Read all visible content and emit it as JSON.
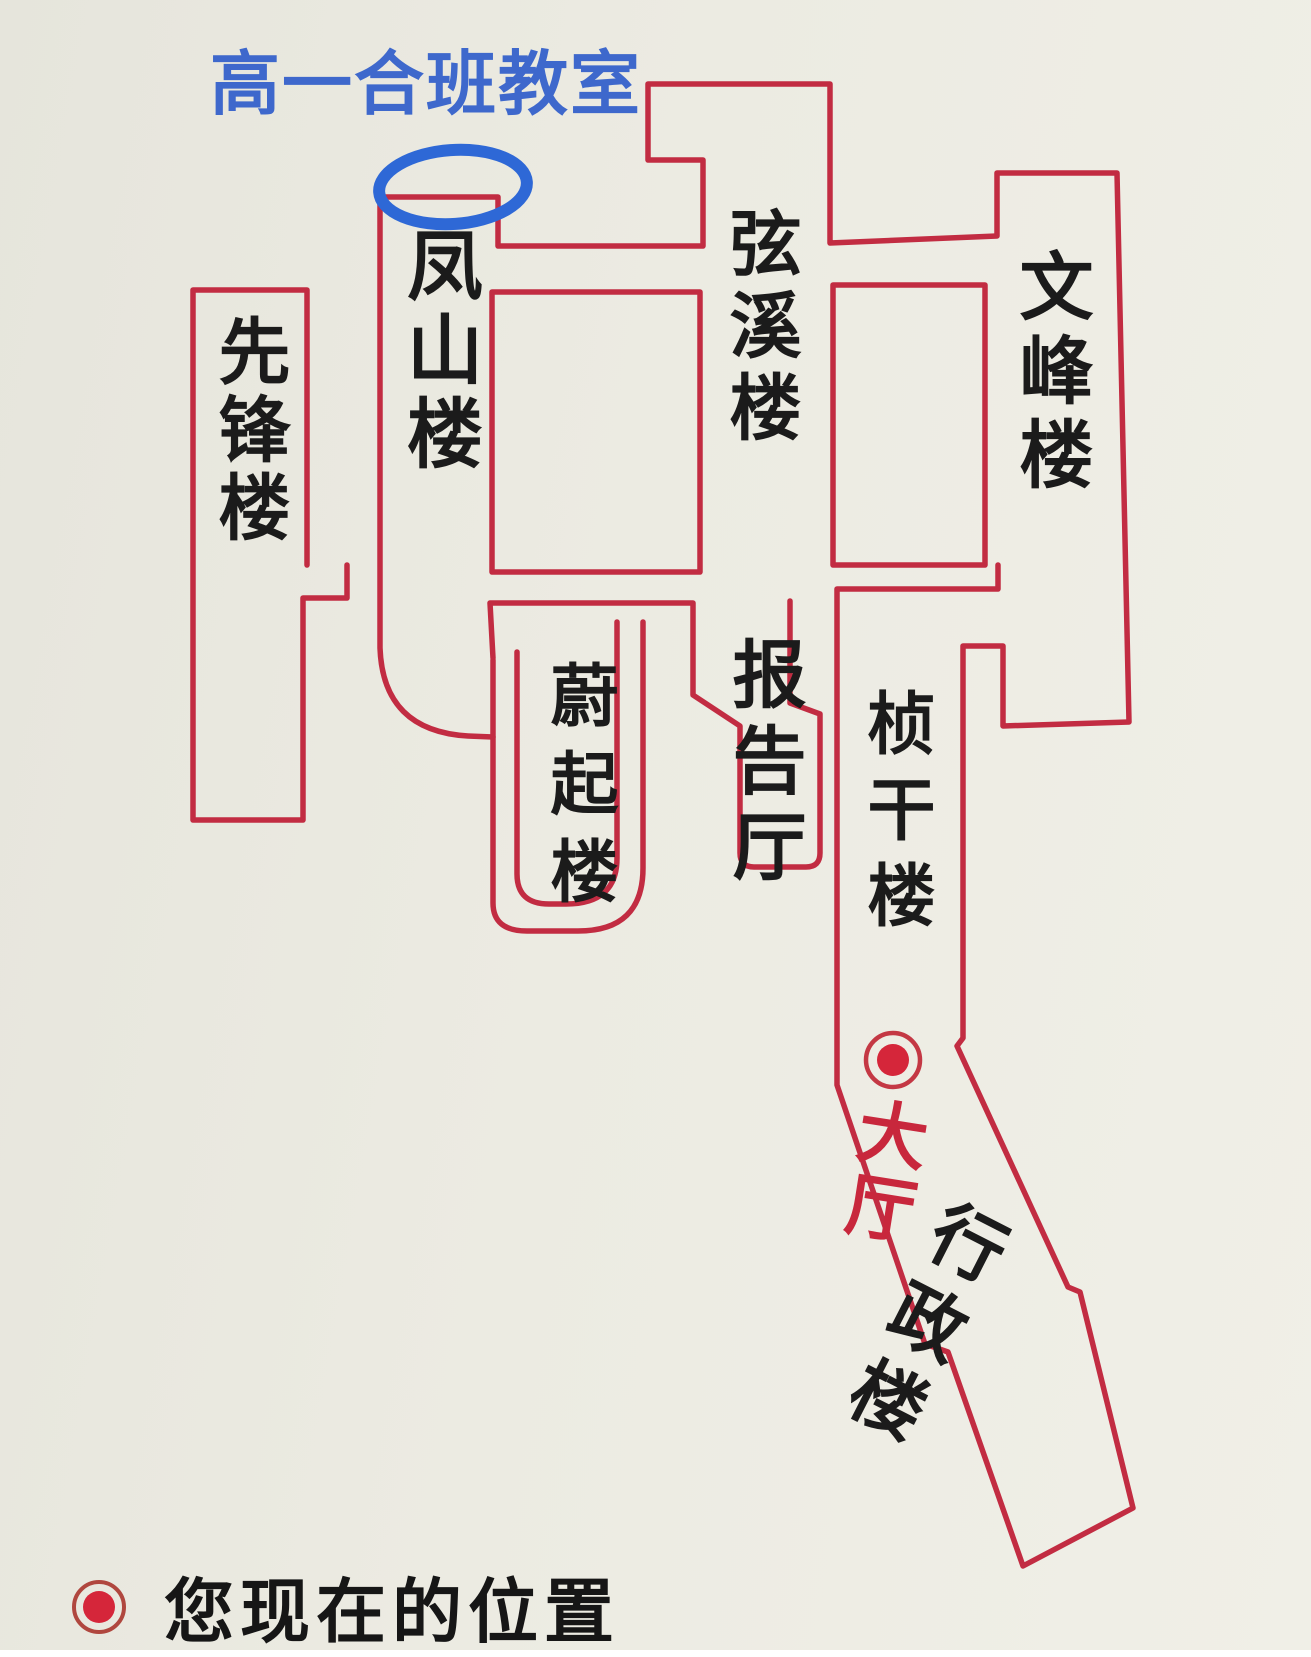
{
  "annotation": {
    "classroom_label": "高一合班教室"
  },
  "buildings": {
    "xianfeng": "先锋楼",
    "fengshan": "凤山楼",
    "xianxi": "弦溪楼",
    "wenfeng": "文峰楼",
    "weiqi": "蔚起楼",
    "lecture_hall": "报告厅",
    "zhengan": "桢干楼",
    "hall": "大厅",
    "admin": "行政楼"
  },
  "legend": {
    "current_location_label": "您现在的位置"
  },
  "colors": {
    "wall_red": "#c22c42",
    "marker_red": "#d5263a",
    "marker_ring": "#c43844",
    "annotation_blue": "#2e68d6",
    "hall_text_red": "#c8273c",
    "title_blue": "#3e68cc",
    "paper": "#ebeae1",
    "ink": "#1b1b1b"
  }
}
